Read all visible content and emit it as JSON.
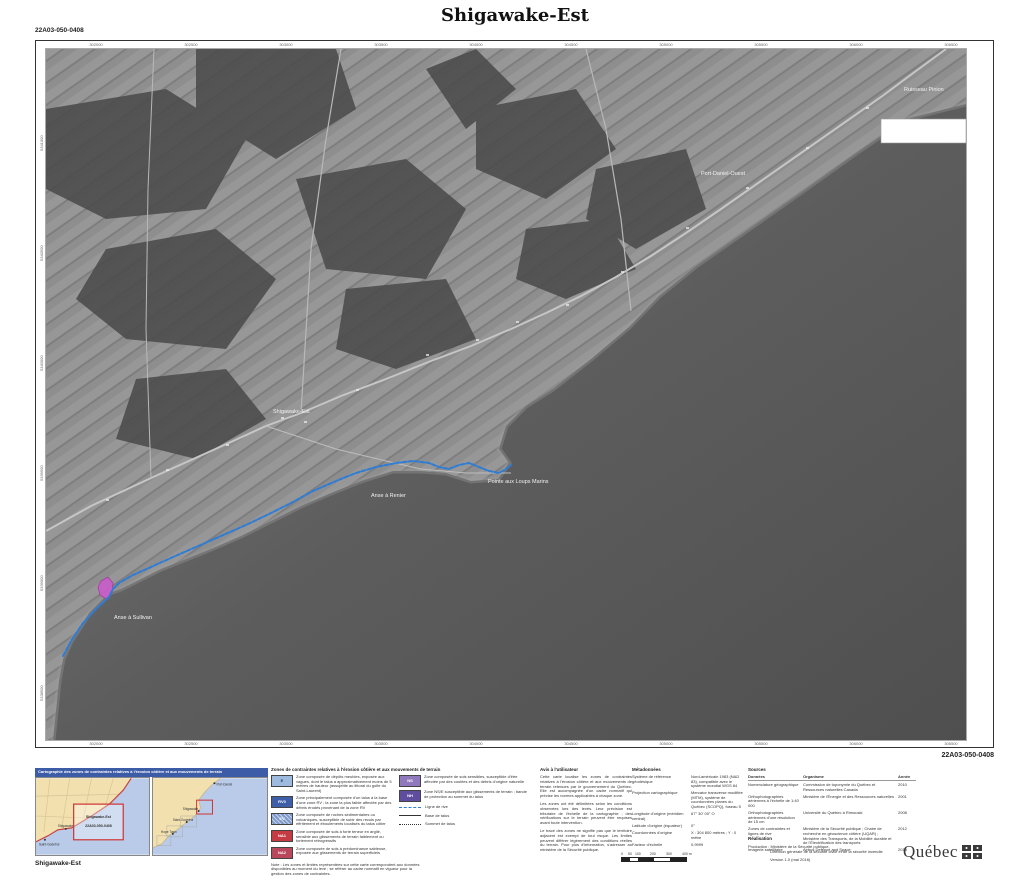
{
  "page": {
    "title": "Shigawake-Est",
    "sheet_code_top": "22A03-050-0408",
    "sheet_code_bottom": "22A03-050-0408",
    "caption_bottom_left": "Shigawake-Est"
  },
  "map": {
    "labels": [
      {
        "text": "Ruisseau Pinion"
      },
      {
        "text": "Port-Daniel-Ouest"
      },
      {
        "text": "Shigawake-Est"
      },
      {
        "text": "Anse à Renier"
      },
      {
        "text": "Pointe aux Loups Marins"
      },
      {
        "text": "Anse à Sullivan"
      }
    ],
    "top_ticks": [
      "302000",
      "302500",
      "303000",
      "303500",
      "304000",
      "304500",
      "305000",
      "305500",
      "306000",
      "306500"
    ],
    "left_ticks": [
      "5341000",
      "5340500",
      "5340000",
      "5339500",
      "5339000",
      "5338500"
    ],
    "shoreline_color": "#2E7CD6",
    "erosion_zone_color": "#C75FC7"
  },
  "locator": {
    "header": "Cartographie des zones de contraintes relatives à l'érosion côtière et aux mouvements de terrain",
    "header_color": "#3D5CA8",
    "land_color": "#F2E0AE",
    "water_color": "#B9CBE8",
    "sheet_outline_color": "#CC3333",
    "left_map": {
      "sheet_name": "Shigawake-Est",
      "sheet_code": "22A03-050-0408",
      "towns": [
        "Shigawake",
        "Saint-Godefroi"
      ]
    },
    "right_map": {
      "towns": [
        "Port-Daniel",
        "Shigawake",
        "Saint-Godefroi",
        "Hope Town"
      ]
    }
  },
  "legend": {
    "title": "Zones de contraintes relatives à l'érosion côtière et aux mouvements de terrain",
    "items": [
      {
        "code": "E",
        "color": "#9FBADF",
        "text": "Zone composée de dépôts meubles, exposée aux vagues, dont le talus a approximativement moins de 5 mètres de hauteur (assujettie au littoral du golfe du Saint-Laurent)"
      },
      {
        "code": "RV0",
        "color": "#3D5EA9",
        "text": "Zone principalement composée d'un talus à la base d'une zone RV ; la zone la plus faible affectée par des débris érodés provenant de la zone RV"
      },
      {
        "code": "EV",
        "color": "#7E99CB",
        "text": "Zone composée de roches sédimentaires ou volcaniques, susceptible de subir des reculs par effritement et éboulements localisés du talus côtier"
      },
      {
        "code": "NA1",
        "color": "#C43B44",
        "text": "Zone composée de sols à forte teneur en argile, sensible aux glissements de terrain faiblement ou fortement rétrogressifs"
      },
      {
        "code": "NA2",
        "color": "#B9485C",
        "text": "Zone composée de sols à prédominance sableuse, exposée aux glissements de terrain superficiels"
      },
      {
        "code": "NS",
        "color": "#9079BC",
        "text": "Zone composée de sols sensibles, susceptible d'être affectée par des coulées et des débris d'origine naturelle"
      },
      {
        "code": "NH",
        "color": "#5F4D9F",
        "text": "Zone NS/E susceptible aux glissements de terrain ; bande de protection au sommet du talus"
      }
    ],
    "lines": [
      {
        "label": "Ligne de rive"
      },
      {
        "label": "Base de talus"
      },
      {
        "label": "Sommet de talus"
      }
    ],
    "note": "Note : Les zones et limites représentées sur cette carte correspondent aux données disponibles au moment du levé ; se référer au cadre normatif en vigueur pour la gestion des zones de contraintes."
  },
  "notice": {
    "title": "Avis à l'utilisateur",
    "paragraphs": [
      "Cette carte localise les zones de contraintes relatives à l'érosion côtière et aux mouvements de terrain retenues par le gouvernement du Québec. Elle est accompagnée d'un cadre normatif qui précise les normes applicables à chaque zone.",
      "Les zones ont été délimitées selon les conditions observées lors des levés. Leur précision est tributaire de l'échelle de la cartographie ; des vérifications sur le terrain peuvent être requises avant toute intervention.",
      "Le tracé des zones ne signifie pas que le territoire adjacent est exempt de tout risque. Les limites peuvent différer légèrement des conditions réelles du terrain. Pour plus d'information, s'adresser au ministère de la Sécurité publique."
    ]
  },
  "scalebar": {
    "labels": [
      "0",
      "50",
      "100",
      "200",
      "300",
      "400 m"
    ]
  },
  "metadata": {
    "title": "Métadonnées",
    "rows": [
      {
        "label": "Système de référence géodésique",
        "value": "Nord-américain 1983 (NAD 83), compatible avec le système mondial WGS 84"
      },
      {
        "label": "Projection cartographique",
        "value": "Mercator transverse modifiée (MTM), système de coordonnées planes du Québec (SCOPQ), fuseau 5"
      },
      {
        "label": "Longitude d'origine (méridien central)",
        "value": "67° 30' 00\" O"
      },
      {
        "label": "Latitude d'origine (équateur)",
        "value": "0°"
      },
      {
        "label": "Coordonnées d'origine",
        "value": "X : 304 800 mètres ; Y : 0 mètre"
      },
      {
        "label": "Facteur d'échelle",
        "value": "0,9999"
      }
    ]
  },
  "sources": {
    "title": "Sources",
    "columns": [
      "Données",
      "Organisme",
      "Année"
    ],
    "rows": [
      {
        "data": "Nomenclature géographique",
        "org": "Commission de toponymie du Québec et Ressources naturelles Canada",
        "year": "2010"
      },
      {
        "data": "Orthophotographies aériennes à l'échelle de 1:40 000",
        "org": "Ministère de l'Énergie et des Ressources naturelles",
        "year": "2001"
      },
      {
        "data": "Orthophotographies aériennes d'une résolution de 15 cm",
        "org": "Université du Québec à Rimouski",
        "year": "2008"
      },
      {
        "data": "Zones de contraintes et lignes de rive",
        "org": "Ministère de la Sécurité publique ; Chaire de recherche en géoscience côtière (UQAR) ; Ministère des Transports, de la Mobilité durable et de l'Électrification des transports",
        "year": "2012"
      },
      {
        "data": "Imagerie satellitaire",
        "org": "Airbus Defence and Space",
        "year": "2013"
      }
    ]
  },
  "realisation": {
    "title": "Réalisation",
    "production_line1": "Production : Ministère de la Sécurité publique,",
    "production_line2": "Direction générale de la sécurité civile et de la sécurité incendie",
    "version": "Version 1.0 (mai 2016)"
  },
  "logo": {
    "text": "Québec"
  }
}
